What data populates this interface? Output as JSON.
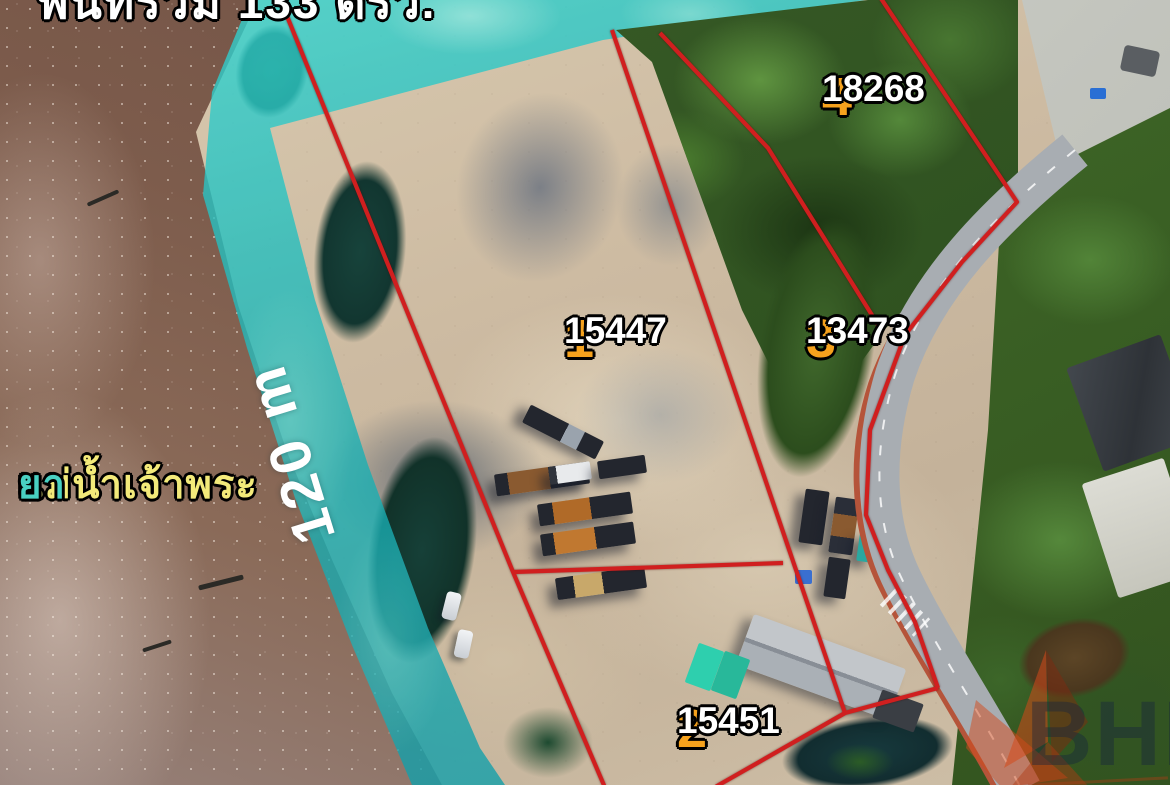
{
  "banner": {
    "text": "พื้นที่รวม 133 ตรว."
  },
  "river_label": {
    "yellow": "แม่น้ำเจ้าพระ",
    "teal": "ยา"
  },
  "scale_label": {
    "text": "120 m"
  },
  "watermark": {
    "text": "BHL"
  },
  "colors": {
    "boundary_red": "#d01f1f",
    "plot_number_orange": "#f6a21d",
    "area_value_white": "#ffffff",
    "river_label_yellow": "#f3ea7a",
    "river_label_teal": "#49d0c2",
    "water_overlay_teal": "#1db4b6"
  },
  "plots": [
    {
      "number": "1",
      "area_value": "15447",
      "cx": 564,
      "cy": 312
    },
    {
      "number": "2",
      "area_value": "15451",
      "cx": 677,
      "cy": 702
    },
    {
      "number": "3",
      "area_value": "13473",
      "cx": 806,
      "cy": 312
    },
    {
      "number": "4",
      "area_value": "18268",
      "cx": 822,
      "cy": 70
    }
  ],
  "boundaries": [
    {
      "name": "west-riverside-line",
      "points": [
        [
          278,
          -6
        ],
        [
          513,
          572
        ],
        [
          606,
          790
        ]
      ]
    },
    {
      "name": "plot1-plot2-divider",
      "points": [
        [
          513,
          572
        ],
        [
          783,
          563
        ]
      ]
    },
    {
      "name": "plot1-plot3-divider",
      "points": [
        [
          612,
          30
        ],
        [
          795,
          567
        ],
        [
          845,
          713
        ]
      ]
    },
    {
      "name": "plot2-south-line",
      "points": [
        [
          845,
          713
        ],
        [
          710,
          790
        ]
      ]
    },
    {
      "name": "plot2-road-connector",
      "points": [
        [
          845,
          713
        ],
        [
          938,
          688
        ]
      ]
    },
    {
      "name": "plot3-plot4-divider",
      "points": [
        [
          660,
          33
        ],
        [
          768,
          148
        ],
        [
          880,
          328
        ]
      ]
    },
    {
      "name": "east-roadside-line",
      "points": [
        [
          878,
          -6
        ],
        [
          1017,
          202
        ],
        [
          962,
          262
        ],
        [
          905,
          335
        ],
        [
          870,
          430
        ],
        [
          866,
          515
        ],
        [
          888,
          570
        ],
        [
          915,
          622
        ],
        [
          938,
          688
        ]
      ]
    }
  ]
}
